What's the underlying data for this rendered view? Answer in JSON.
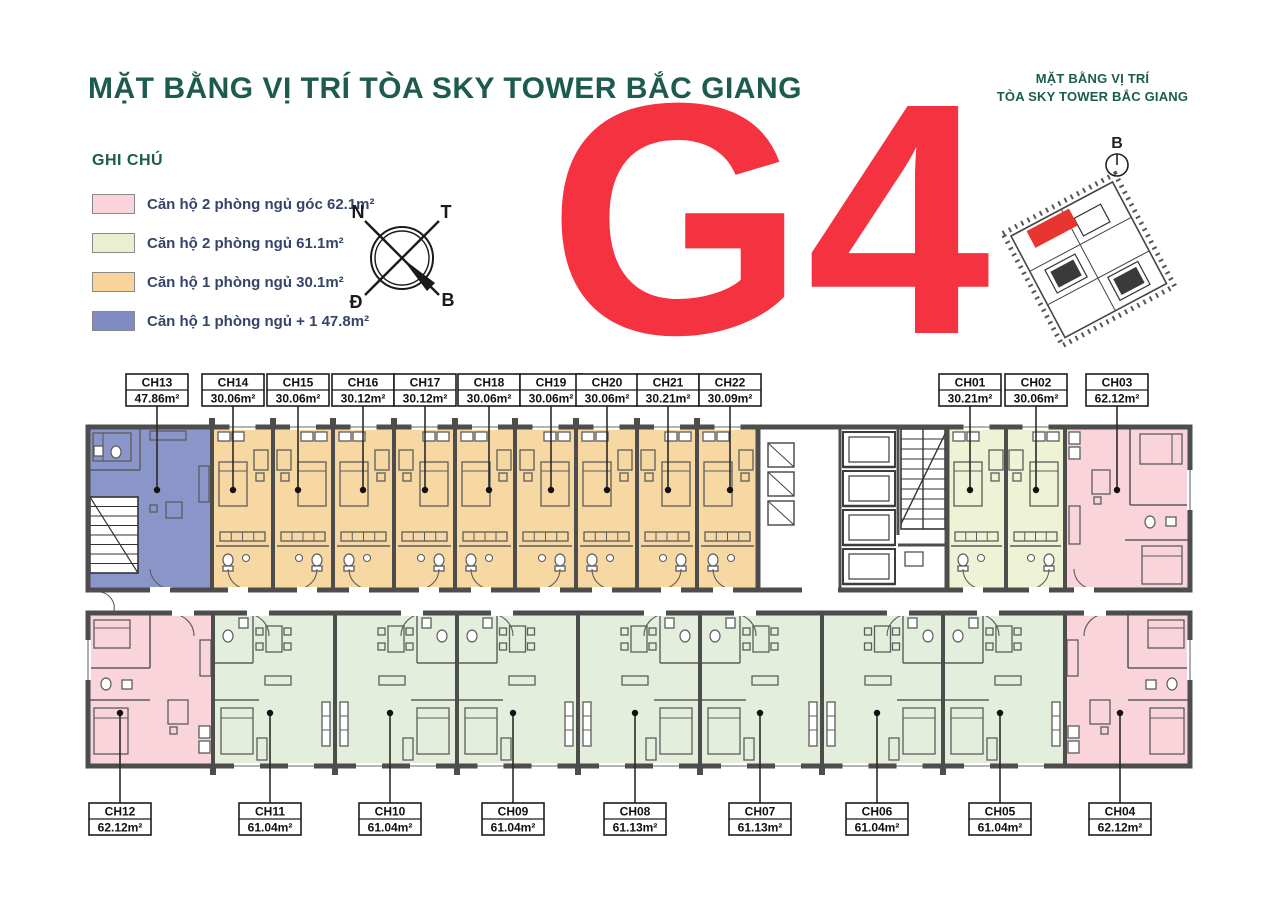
{
  "title": "MẶT BẰNG VỊ TRÍ TÒA SKY TOWER BẮC GIANG",
  "tower_code": "G4",
  "legend": {
    "heading": "GHI CHÚ",
    "items": [
      {
        "label": "Căn hộ 2 phòng ngủ góc 62.1m²",
        "color": "#fbd3da"
      },
      {
        "label": "Căn hộ 2 phòng ngủ 61.1m²",
        "color": "#e9f0cf"
      },
      {
        "label": "Căn hộ 1 phòng ngủ 30.1m²",
        "color": "#f8d49a"
      },
      {
        "label": "Căn hộ 1 phòng ngủ + 1 47.8m²",
        "color": "#7f8cc4"
      }
    ]
  },
  "compass": {
    "nw": "N",
    "ne": "T",
    "sw": "Đ",
    "se": "B"
  },
  "minimap": {
    "title_line1": "MẶT BẰNG VỊ TRÍ",
    "title_line2": "TÒA SKY TOWER BẮC GIANG",
    "compass_label": "B",
    "highlight_color": "#e8352f"
  },
  "floor_plan": {
    "colors": {
      "wall": "#4d4d4d",
      "furniture": "#5c5c5c",
      "blue": "#8a95ca",
      "studio": "#f8d8a2",
      "pale": "#eff3d5",
      "green2br": "#e3efdc",
      "pink": "#f9d4db",
      "white": "#ffffff"
    },
    "top_units": [
      {
        "id": "CH13",
        "area": "47.86m²",
        "type": "blue",
        "x0": 88,
        "x1": 212,
        "label_x": 157
      },
      {
        "id": "CH14",
        "area": "30.06m²",
        "type": "studio",
        "x0": 212,
        "x1": 273,
        "label_x": 233
      },
      {
        "id": "CH15",
        "area": "30.06m²",
        "type": "studio",
        "x0": 273,
        "x1": 333,
        "label_x": 298
      },
      {
        "id": "CH16",
        "area": "30.12m²",
        "type": "studio",
        "x0": 333,
        "x1": 394,
        "label_x": 363
      },
      {
        "id": "CH17",
        "area": "30.12m²",
        "type": "studio",
        "x0": 394,
        "x1": 455,
        "label_x": 425
      },
      {
        "id": "CH18",
        "area": "30.06m²",
        "type": "studio",
        "x0": 455,
        "x1": 515,
        "label_x": 489
      },
      {
        "id": "CH19",
        "area": "30.06m²",
        "type": "studio",
        "x0": 515,
        "x1": 576,
        "label_x": 551
      },
      {
        "id": "CH20",
        "area": "30.06m²",
        "type": "studio",
        "x0": 576,
        "x1": 637,
        "label_x": 607
      },
      {
        "id": "CH21",
        "area": "30.21m²",
        "type": "studio",
        "x0": 637,
        "x1": 697,
        "label_x": 668
      },
      {
        "id": "CH22",
        "area": "30.09m²",
        "type": "studio",
        "x0": 697,
        "x1": 758,
        "label_x": 730
      },
      {
        "id": "CH01",
        "area": "30.21m²",
        "type": "pale",
        "x0": 947,
        "x1": 1006,
        "label_x": 970
      },
      {
        "id": "CH02",
        "area": "30.06m²",
        "type": "pale",
        "x0": 1006,
        "x1": 1065,
        "label_x": 1036
      },
      {
        "id": "CH03",
        "area": "62.12m²",
        "type": "pink",
        "x0": 1065,
        "x1": 1190,
        "label_x": 1117
      }
    ],
    "bottom_units": [
      {
        "id": "CH12",
        "area": "62.12m²",
        "type": "pink",
        "x0": 88,
        "x1": 213,
        "label_x": 120
      },
      {
        "id": "CH11",
        "area": "61.04m²",
        "type": "green2br",
        "x0": 213,
        "x1": 335,
        "label_x": 270
      },
      {
        "id": "CH10",
        "area": "61.04m²",
        "type": "green2br",
        "x0": 335,
        "x1": 457,
        "label_x": 390
      },
      {
        "id": "CH09",
        "area": "61.04m²",
        "type": "green2br",
        "x0": 457,
        "x1": 578,
        "label_x": 513
      },
      {
        "id": "CH08",
        "area": "61.13m²",
        "type": "green2br",
        "x0": 578,
        "x1": 700,
        "label_x": 635
      },
      {
        "id": "CH07",
        "area": "61.13m²",
        "type": "green2br",
        "x0": 700,
        "x1": 822,
        "label_x": 760
      },
      {
        "id": "CH06",
        "area": "61.04m²",
        "type": "green2br",
        "x0": 822,
        "x1": 943,
        "label_x": 877
      },
      {
        "id": "CH05",
        "area": "61.04m²",
        "type": "green2br",
        "x0": 943,
        "x1": 1065,
        "label_x": 1000
      },
      {
        "id": "CH04",
        "area": "62.12m²",
        "type": "pink",
        "x0": 1065,
        "x1": 1190,
        "label_x": 1120
      }
    ]
  }
}
